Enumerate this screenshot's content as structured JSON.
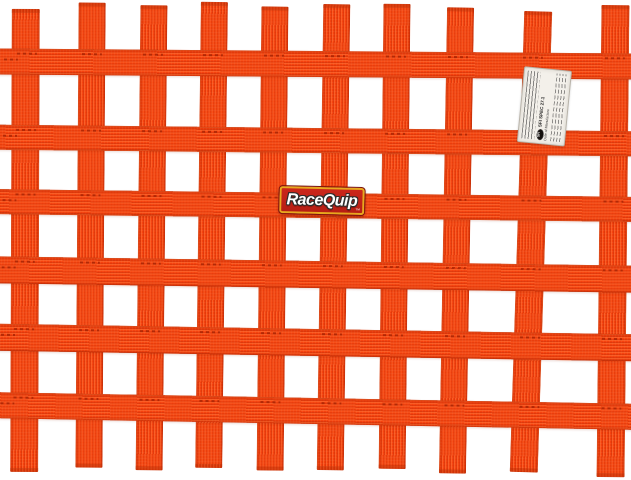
{
  "background_color": "#ffffff",
  "net": {
    "columns": 10,
    "rows": 6,
    "webbing_color": "#f5420e",
    "webbing_highlight": "#ff7a3c",
    "webbing_shadow": "#c03305"
  },
  "brand_label": {
    "text": "RaceQuip",
    "trademark": "™",
    "bg_color": "#cd271c",
    "gold_border_color": "#e7a81e",
    "text_color": "#ffffff"
  },
  "sfi_tag": {
    "logo_text": "SFI",
    "spec_text": "SFI SPEC 27.1",
    "date_label": "Date of Manufacture",
    "bg_color": "#f3f0ea"
  }
}
